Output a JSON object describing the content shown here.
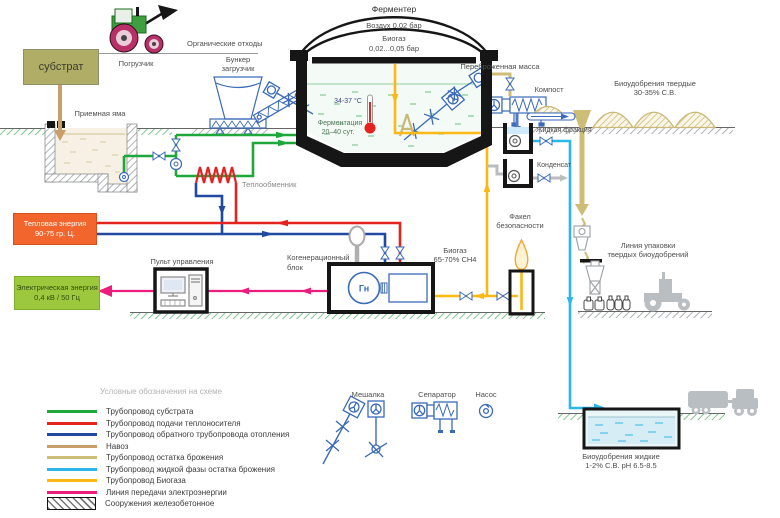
{
  "colors": {
    "substrate_pipe": "#1ea83b",
    "heat_supply_pipe": "#e42320",
    "heat_return_pipe": "#2149a0",
    "manure": "#c89e6a",
    "digestate_pipe": "#cdbd76",
    "liquid_phase_pipe": "#2bb7ea",
    "biogas_pipe": "#fcb815",
    "power_line": "#ec1d7c",
    "equipment_outline": "#3a6ab8",
    "substrate_box_bg": "#b0ad66",
    "heat_box_bg": "#f2662d",
    "electric_box_bg": "#9cc83e"
  },
  "labels": {
    "fermenter_title": "Ферментер",
    "air_pressure": "Воздух 0,02 бар",
    "biogas_name": "Биогаз",
    "biogas_pressure": "0,02...0,05 бар",
    "temperature": "34-37 °С",
    "fermentation_1": "Ферментация",
    "fermentation_2": "20–40 сут.",
    "substrate": "субстрат",
    "loader": "Погрузчик",
    "organic_waste": "Органические отходы",
    "hopper_1": "Бункер",
    "hopper_2": "загрузчик",
    "receiving_pit": "Приемная яма",
    "heat_exchanger": "Теплообменник",
    "heat_energy_1": "Тепловая энергия",
    "heat_energy_2": "90-75 гр. Ц.",
    "electric_energy_1": "Электрическая энергия",
    "electric_energy_2": "0,4 кВ / 50 Гц",
    "control_panel": "Пульт управления",
    "cogeneration_1": "Когенерационный",
    "cogeneration_2": "блок",
    "generator": "Гн",
    "biogas_ch4_1": "Биогаз",
    "biogas_ch4_2": "65-70% СН4",
    "flare_1": "Факел",
    "flare_2": "безопасности",
    "digested_mass": "Переброженная масса",
    "compost": "Компост",
    "liquid_fraction": "Жидкая фракция",
    "condensate": "Конденсат",
    "solid_fert_1": "Биоудобрения твердые",
    "solid_fert_2": "30-35% С.В.",
    "packing_1": "Линия упаковки",
    "packing_2": "твердых биоудобрений",
    "liquid_fert_1": "Биоудобрения жидкие",
    "liquid_fert_2": "1-2% С.В.  рН 6.5-8.5",
    "mixer": "Мешалка",
    "separator": "Сепаратор",
    "pump": "Насос"
  },
  "legend": {
    "title": "Условные обозначения на схеме",
    "items": [
      {
        "label": "Трубопровод субстрата",
        "color": "#1ea83b"
      },
      {
        "label": "Трубопровод подачи теплоносителя",
        "color": "#e42320"
      },
      {
        "label": "Трубопровод обратного трубопровода отопления",
        "color": "#2149a0"
      },
      {
        "label": "Навоз",
        "color": "#c89e6a"
      },
      {
        "label": "Трубопровод остатка брожения",
        "color": "#cdbd76"
      },
      {
        "label": "Трубопровод жидкой фазы остатка брожения",
        "color": "#2bb7ea"
      },
      {
        "label": "Трубопровод Биогаза",
        "color": "#fcb815"
      },
      {
        "label": "Линия передачи электроэнергии",
        "color": "#ec1d7c"
      },
      {
        "label": "Сооружения железобетонное",
        "type": "hatched"
      }
    ]
  }
}
